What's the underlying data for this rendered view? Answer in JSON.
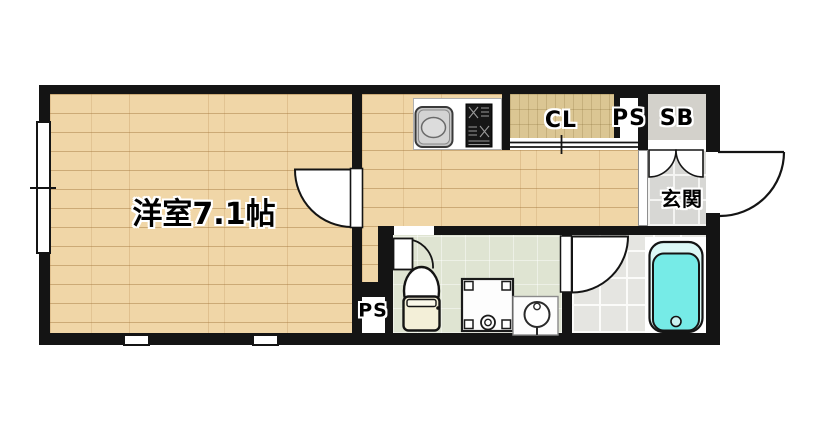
{
  "floorplan": {
    "type": "apartment-floor-plan",
    "rooms": {
      "living": {
        "label": "洋室7.1帖"
      },
      "closet": {
        "label": "CL"
      },
      "pipe_space_top": {
        "label": "PS"
      },
      "shoe_box": {
        "label": "SB"
      },
      "entrance": {
        "label": "玄関"
      },
      "pipe_space_bottom": {
        "label": "PS"
      }
    },
    "colors": {
      "wall": "#141414",
      "wood_floor": "#f0d6a7",
      "closet_floor": "#dbc693",
      "entrance_tile": "#d7d7d4",
      "bath_tile": "#e5e5e1",
      "toilet_floor": "#dfe4d2",
      "shoe_box_gray": "#d3d1cb",
      "bathtub_cyan": "#76ebe7",
      "background": "#ffffff"
    }
  }
}
